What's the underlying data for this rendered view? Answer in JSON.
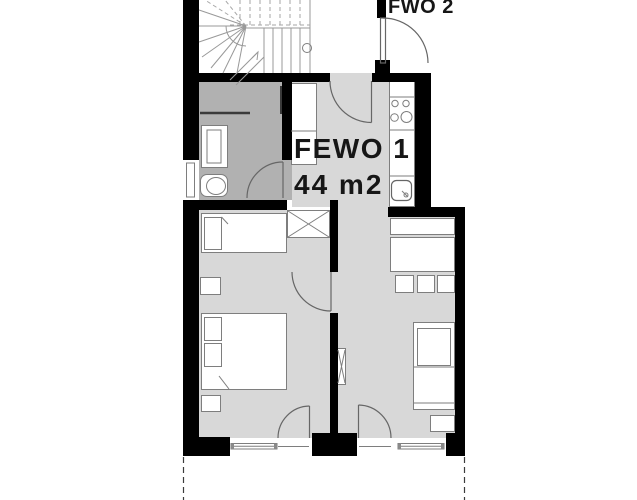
{
  "labels": {
    "apartment": "FEWO 1",
    "area": "44 m2",
    "neighbor_apartment": "FWO 2"
  },
  "colors": {
    "wall": "#000000",
    "room_floor": "#d8d8d8",
    "bathroom_floor": "#b1b1b1",
    "furniture": "#ffffff",
    "outline": "#7e7e7e",
    "background": "#ffffff"
  }
}
